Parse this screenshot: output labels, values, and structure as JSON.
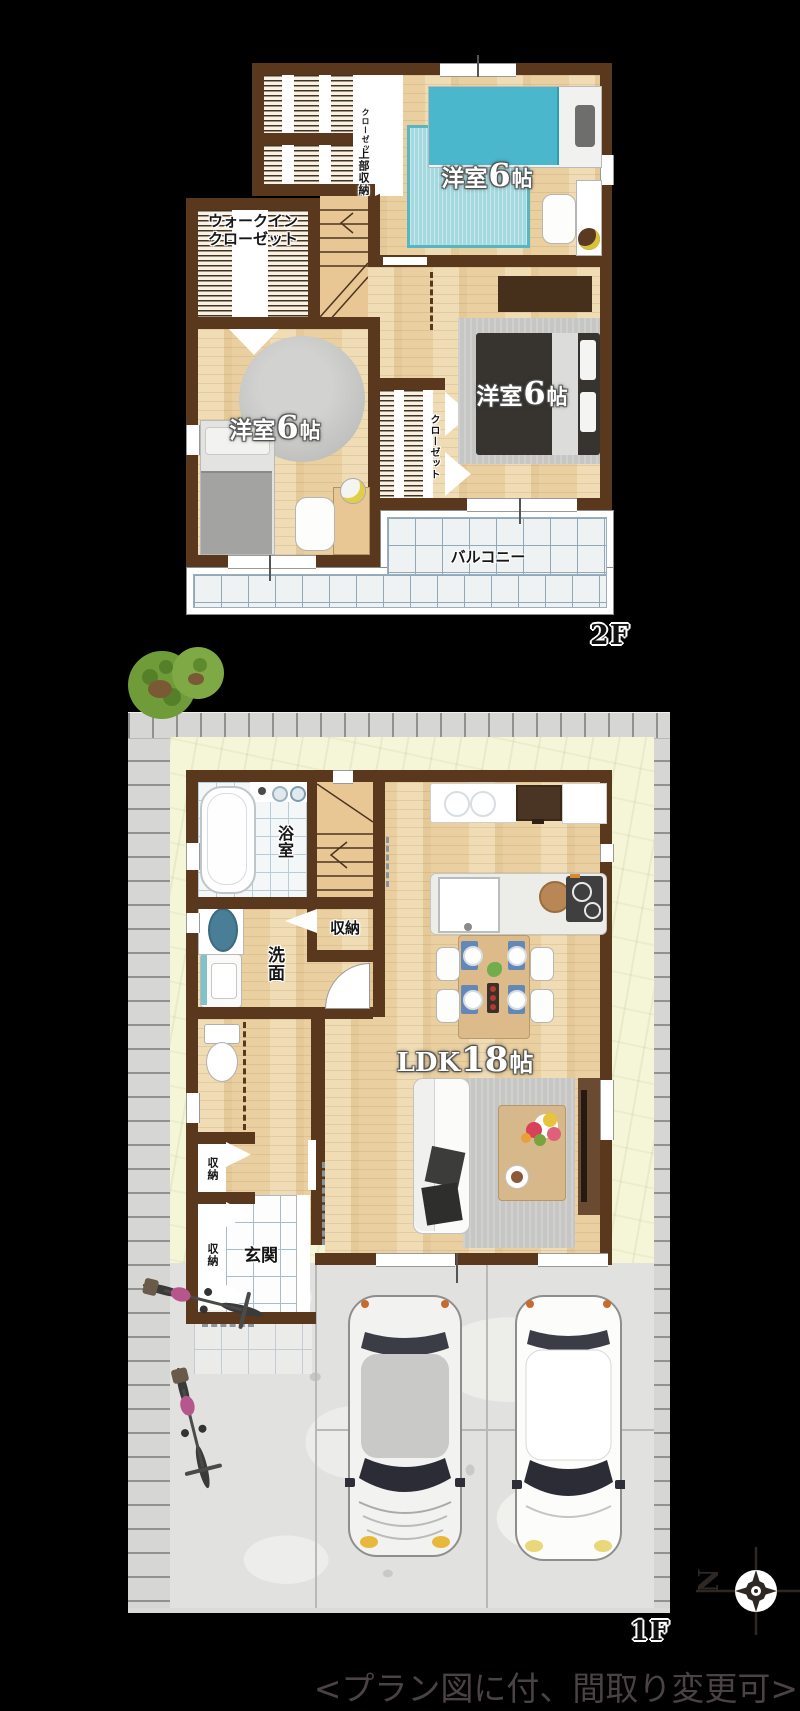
{
  "colors": {
    "wall": "#5a381d",
    "wood": "#ead0a1",
    "tatami": "#a3d9df",
    "tatami_border": "#58b6c3",
    "tile_line": "#a5bccd",
    "balcony_line": "#8fa8ba",
    "lawn": "#f5f6d7",
    "paver": "#d6d6d4",
    "concrete": "#e1e1df",
    "tree": "#6f9c39",
    "bike_accent": "#b5568d",
    "bed_blue": "#4ab7cd",
    "note": "#4a4244"
  },
  "floor2": {
    "floor_label": "2F",
    "closet_top": "クローゼット",
    "upper_storage": "上部収納",
    "wic_line1": "ウォークイン",
    "wic_line2": "クローゼット",
    "closet_mid": "クローゼット",
    "balcony": "バルコニー",
    "bedroom_top": {
      "pre": "洋室",
      "num": "6",
      "post": "帖"
    },
    "bedroom_left": {
      "pre": "洋室",
      "num": "6",
      "post": "帖"
    },
    "bedroom_right": {
      "pre": "洋室",
      "num": "6",
      "post": "帖"
    }
  },
  "floor1": {
    "floor_label": "1F",
    "bath": "浴室",
    "stair_storage": "収納",
    "washroom": "洗面",
    "hall_storage": "収納",
    "entry_storage": "収納",
    "entrance": "玄関",
    "ldk": {
      "pre": "LDK",
      "num": "18",
      "post": "帖"
    }
  },
  "compass": {
    "letter": "N"
  },
  "footnote": "<プラン図に付、間取り変更可>"
}
